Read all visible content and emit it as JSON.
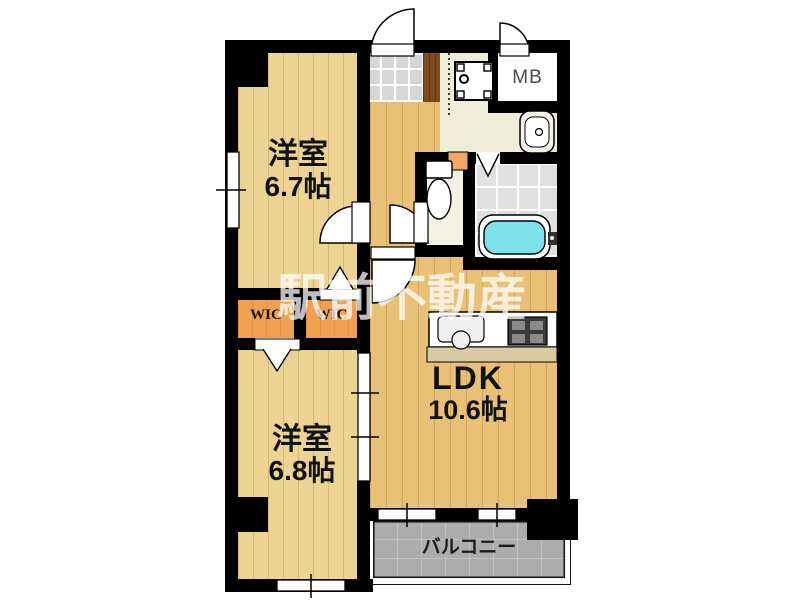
{
  "floorplan": {
    "watermark": "駅前不動産",
    "room_67": {
      "name": "洋室",
      "size": "6.7帖"
    },
    "room_68": {
      "name": "洋室",
      "size": "6.8帖"
    },
    "ldk": {
      "name": "LDK",
      "size": "10.6帖"
    },
    "wic_left": {
      "label": "WIC"
    },
    "wic_right": {
      "label": "WIC"
    },
    "meter_box": {
      "label": "MB"
    },
    "balcony": {
      "label": "バルコニー"
    },
    "colors": {
      "wall": "#000000",
      "room_floor": "#EDD494",
      "ldk_floor": "#E8C177",
      "wic_floor": "#F0A051",
      "hall_floor": "#EFEDD8",
      "genkan_tile": "#D7D7D7",
      "step_wood": "#7B4A1F",
      "bath_floor": "#E0E0E0",
      "bathtub": "#7CE1E8",
      "balcony_floor": "#ACACAC",
      "counter_front": "#D8CBA4",
      "toilet_shelf": "#F2A469",
      "background": "#FFFFFF"
    }
  }
}
